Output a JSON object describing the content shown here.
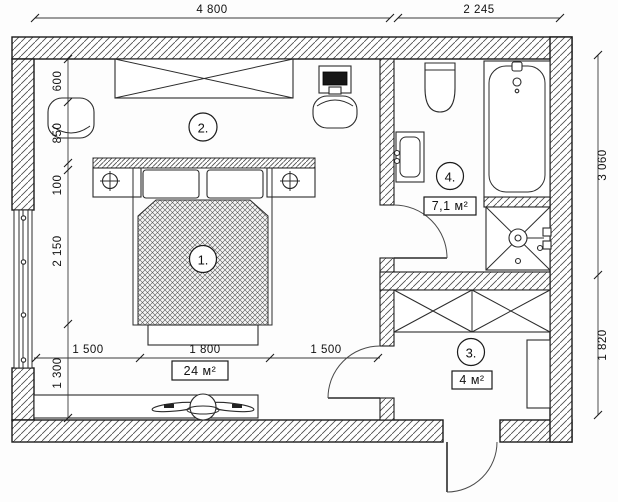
{
  "drawing": {
    "kind": "apartment floor plan"
  },
  "dimensions": {
    "top": [
      "4 800",
      "2 245"
    ],
    "right": [
      "3 060",
      "1 820"
    ],
    "left": [
      "600",
      "850",
      "100",
      "2 150",
      "1 300"
    ],
    "bottom": [
      "1 500",
      "1 800",
      "1 500"
    ]
  },
  "rooms": [
    {
      "label": "1."
    },
    {
      "label": "2.",
      "area": "24 м²"
    },
    {
      "label": "3.",
      "area": "4 м²"
    },
    {
      "label": "4.",
      "area": "7,1 м²"
    }
  ],
  "colors": {
    "line": "#1b1b1b",
    "background": "#fdfdfd"
  }
}
